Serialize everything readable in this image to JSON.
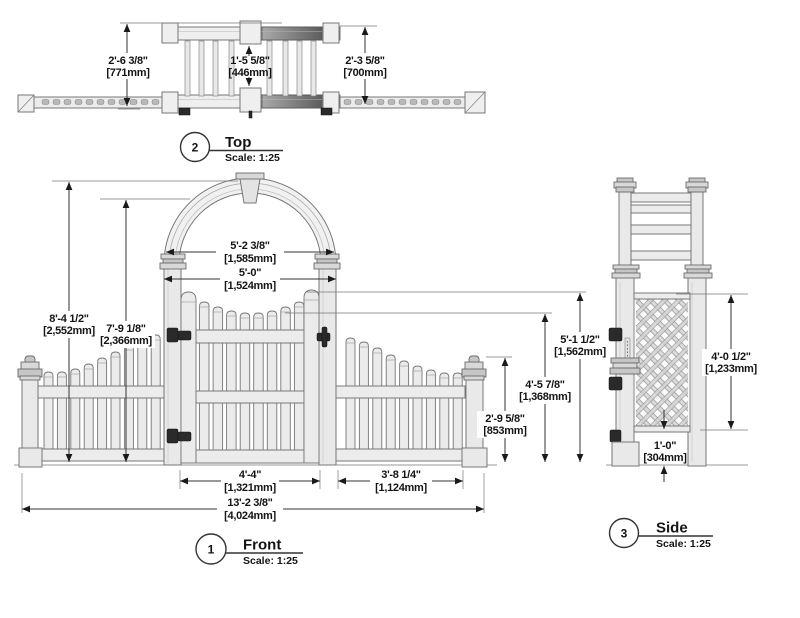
{
  "drawing_title": "Arbor gate with picket fence wings - dimensioned views",
  "views": {
    "top": {
      "number": "2",
      "name": "Top",
      "scale": "Scale: 1:25",
      "dims": {
        "overall_depth": {
          "imp": "2'-6 3/8\"",
          "mm": "[771mm]"
        },
        "inner_depth": {
          "imp": "1'-5 5/8\"",
          "mm": "[446mm]"
        },
        "frame_depth": {
          "imp": "2'-3 5/8\"",
          "mm": "[700mm]"
        }
      }
    },
    "front": {
      "number": "1",
      "name": "Front",
      "scale": "Scale: 1:25",
      "dims": {
        "overall_height": {
          "imp": "8'-4 1/2\"",
          "mm": "[2,552mm]"
        },
        "clearance_height": {
          "imp": "7'-9 1/8\"",
          "mm": "[2,366mm]"
        },
        "arch_width": {
          "imp": "5'-2 3/8\"",
          "mm": "[1,585mm]"
        },
        "post_spacing": {
          "imp": "5'-0\"",
          "mm": "[1,524mm]"
        },
        "gate_width": {
          "imp": "4'-4\"",
          "mm": "[1,321mm]"
        },
        "wing_width": {
          "imp": "3'-8 1/4\"",
          "mm": "[1,124mm]"
        },
        "overall_width": {
          "imp": "13'-2 3/8\"",
          "mm": "[4,024mm]"
        },
        "gate_height": {
          "imp": "5'-1 1/2\"",
          "mm": "[1,562mm]"
        },
        "picket_height": {
          "imp": "4'-5 7/8\"",
          "mm": "[1,368mm]"
        },
        "end_post_height": {
          "imp": "2'-9 5/8\"",
          "mm": "[853mm]"
        }
      }
    },
    "side": {
      "number": "3",
      "name": "Side",
      "scale": "Scale: 1:25",
      "dims": {
        "lattice_height": {
          "imp": "4'-0 1/2\"",
          "mm": "[1,233mm]"
        },
        "bottom_clearance": {
          "imp": "1'-0\"",
          "mm": "[304mm]"
        }
      }
    }
  },
  "geometry": {
    "left_panel_picket_tops": [
      372,
      372,
      369,
      364,
      358,
      352,
      345,
      339,
      335
    ],
    "right_panel_picket_tops": [
      338,
      342,
      348,
      355,
      361,
      366,
      370,
      373,
      373
    ],
    "gate_picket_tops": [
      302,
      307,
      311,
      313,
      313,
      311,
      307,
      302
    ],
    "top_view_bar_xs": [
      185,
      199,
      213,
      229,
      267,
      283,
      297,
      311
    ]
  }
}
